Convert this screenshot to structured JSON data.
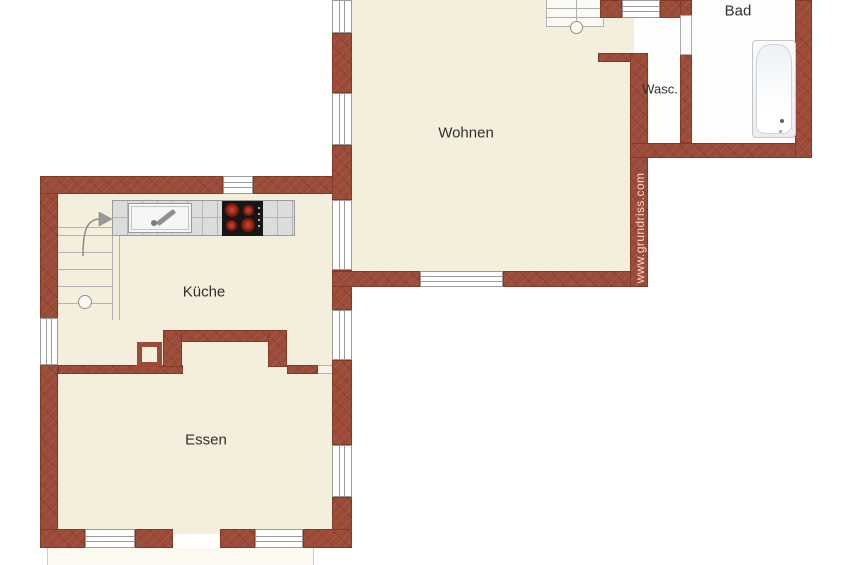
{
  "plan": {
    "title": "floor-plan",
    "watermark": "www.grundriss.com",
    "rooms": {
      "wohnen": {
        "label": "Wohnen"
      },
      "kueche": {
        "label": "Küche"
      },
      "essen": {
        "label": "Essen"
      },
      "bad": {
        "label": "Bad"
      },
      "wasc": {
        "label": "Wasc."
      }
    },
    "fixtures": {
      "bathtub": "bathtub",
      "kitchen_sink": "kitchen-sink-with-faucet",
      "cooktop": "cooktop-4-burners",
      "stairs_main": "staircase-upper",
      "stairs_kitchen": "staircase-with-up-arrow",
      "chimney": "chimney-block"
    },
    "colors": {
      "wall": "#9c4b38",
      "floor": "#f4efdd",
      "wet_room_floor": "#fdfdfc",
      "counter": "#dcdcdc",
      "cooktop": "#161616",
      "burner": "#8e2014",
      "label_text": "#2f2f2f",
      "watermark": "#f3d9cc"
    }
  }
}
